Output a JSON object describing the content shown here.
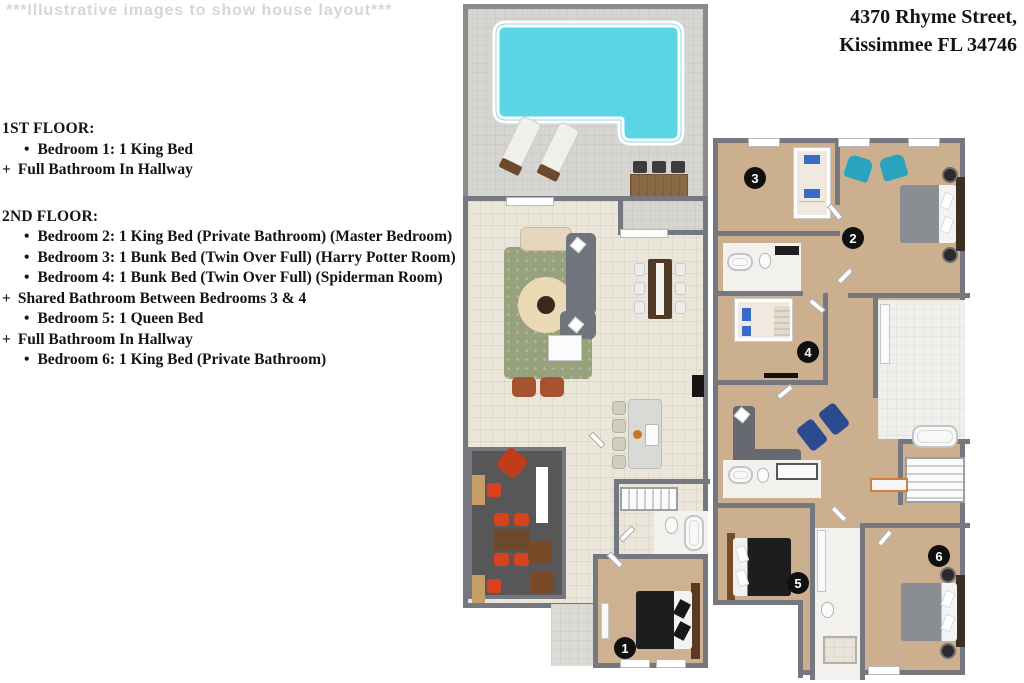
{
  "watermark": "***Illustrative images to show house layout***",
  "address": {
    "line1": "4370 Rhyme Street,",
    "line2": "Kissimmee FL 34746"
  },
  "floor_list": {
    "floor1": {
      "heading": "1ST FLOOR:",
      "items": [
        {
          "marker": "•",
          "text": "Bedroom 1: 1 King Bed"
        },
        {
          "marker": "+",
          "text": "Full Bathroom In Hallway"
        }
      ]
    },
    "floor2": {
      "heading": "2ND FLOOR:",
      "items": [
        {
          "marker": "•",
          "text": "Bedroom 2: 1 King Bed (Private Bathroom) (Master Bedroom)"
        },
        {
          "marker": "•",
          "text": "Bedroom 3: 1 Bunk Bed (Twin Over Full) (Harry Potter Room)"
        },
        {
          "marker": "•",
          "text": "Bedroom 4: 1 Bunk Bed (Twin Over Full) (Spiderman Room)"
        },
        {
          "marker": "+",
          "text": "Shared Bathroom Between Bedrooms 3 & 4"
        },
        {
          "marker": "•",
          "text": "Bedroom 5: 1 Queen Bed"
        },
        {
          "marker": "+",
          "text": "Full Bathroom In Hallway"
        },
        {
          "marker": "•",
          "text": "Bedroom 6: 1 King Bed (Private Bathroom)"
        }
      ]
    }
  },
  "badges": {
    "bedroom1": "1",
    "bedroom2": "2",
    "bedroom3": "3",
    "bedroom4": "4",
    "bedroom5": "5",
    "bedroom6": "6"
  },
  "colors": {
    "pool": "#59d5e6",
    "patio": "#d6d5d1",
    "tile_floor": "#ebe6d9",
    "carpet": "#cdb190",
    "wall": "#75787e",
    "game_room_floor": "#575757",
    "teal_chair": "#2aa4be",
    "navy_lounger": "#2c4b8f",
    "orange_chair": "#d9411e",
    "badge": "#101010"
  }
}
